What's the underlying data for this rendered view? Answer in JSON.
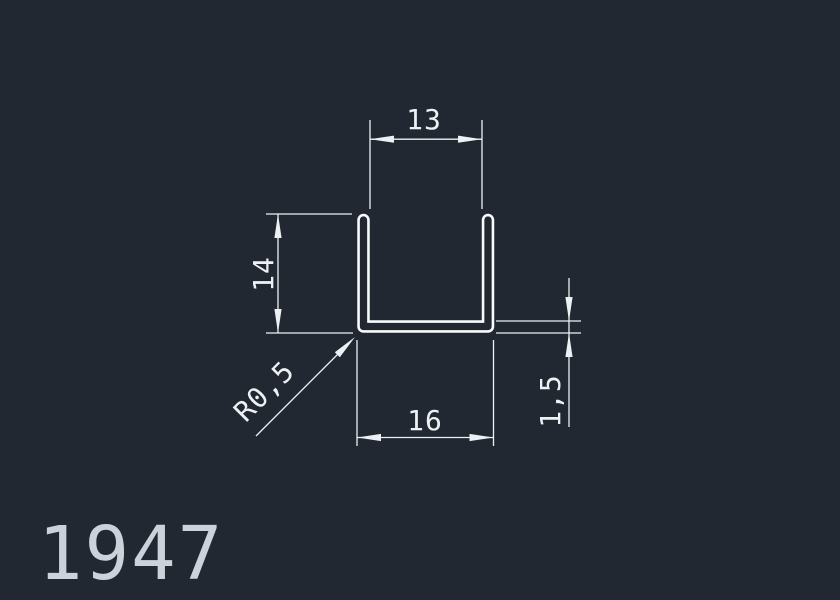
{
  "part_number": "1947",
  "drawing": {
    "shape": "u-channel-profile-cross-section",
    "labels": {
      "top_inner_width": "13",
      "left_height": "14",
      "bottom_outer_width": "16",
      "wall_thickness": "1,5",
      "corner_radius": "R0,5"
    },
    "colors": {
      "background": "#212831",
      "dimension_lines": "#edf1f4",
      "profile_outline": "#f8fafb",
      "part_number_text": "#ccd2d9"
    }
  }
}
